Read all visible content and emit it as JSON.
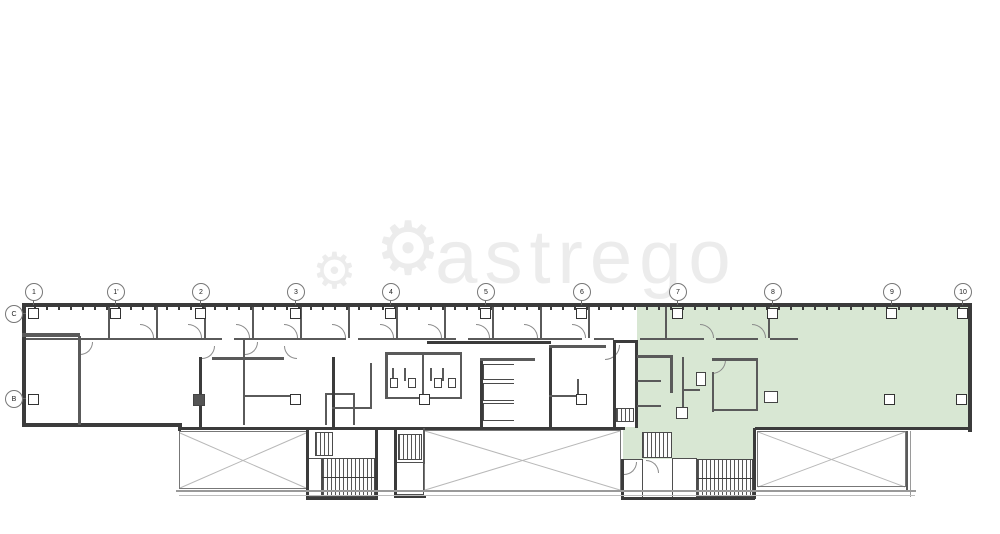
{
  "watermark": {
    "text": "astrego",
    "gear_icon": "⚙"
  },
  "highlight": {
    "label": "highlighted-lease-area",
    "color": "#d8e7d3"
  },
  "colors": {
    "wall_dark": "#3b3b3b",
    "wall_mid": "#5a5a5a",
    "watermark_gray": "#ececec",
    "terrace_line": "#b8b8b8"
  },
  "grid": {
    "bubble_row_y": 283,
    "top_columns": [
      {
        "label": "1",
        "x": 33
      },
      {
        "label": "1'",
        "x": 115
      },
      {
        "label": "2",
        "x": 200
      },
      {
        "label": "3",
        "x": 295
      },
      {
        "label": "4",
        "x": 390
      },
      {
        "label": "5",
        "x": 485
      },
      {
        "label": "6",
        "x": 581
      },
      {
        "label": "7",
        "x": 677
      },
      {
        "label": "8",
        "x": 772
      },
      {
        "label": "9",
        "x": 891
      },
      {
        "label": "10",
        "x": 962
      }
    ],
    "left_rows": [
      {
        "label": "C",
        "y": 313
      },
      {
        "label": "B",
        "y": 398
      }
    ]
  },
  "columns": {
    "row1_y": 313,
    "row1_x": [
      33,
      115,
      200,
      295,
      390,
      485,
      581,
      677,
      772,
      891,
      962
    ],
    "row2_y": 399,
    "row2_x": [
      33,
      295,
      424,
      581,
      889,
      961
    ]
  }
}
